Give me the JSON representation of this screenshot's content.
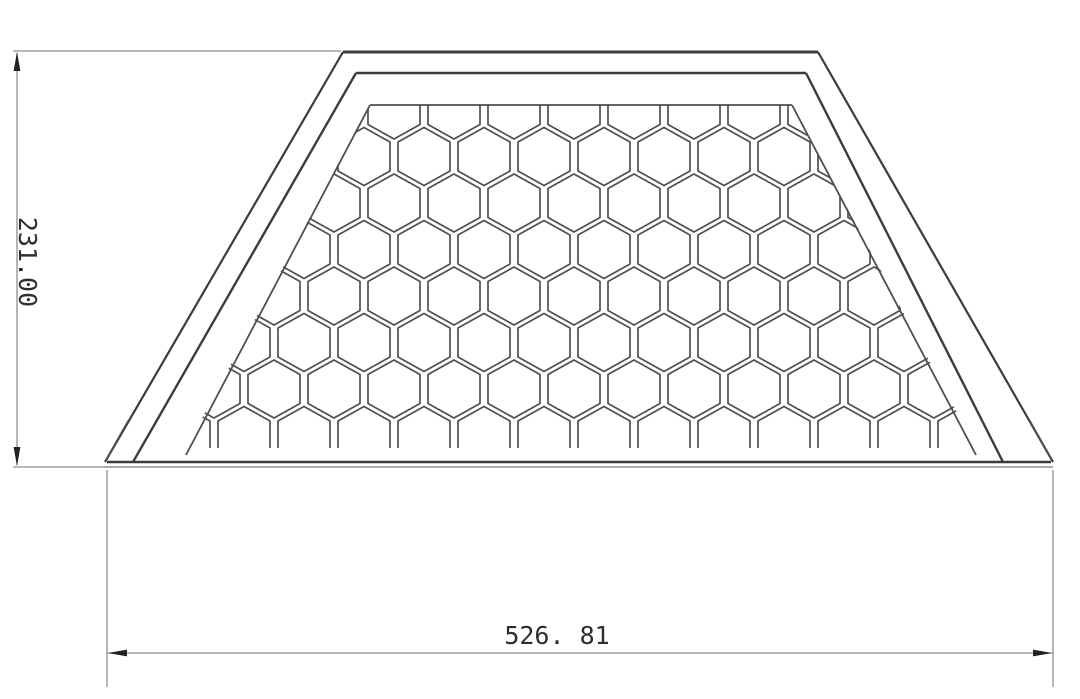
{
  "drawing": {
    "type": "technical-drawing",
    "view": "front-view-trapezoidal-honeycomb-grille",
    "background_color": "#ffffff",
    "line_colors": {
      "dark": "#3c3c3c",
      "medium": "#4f4f4f",
      "light": "#8f8f8f",
      "arrow": "#222222",
      "text": "#2e2e2e"
    },
    "dimensions": {
      "height": {
        "value": "231.00",
        "orientation": "vertical",
        "units_shown": false
      },
      "width": {
        "value": "526. 81",
        "orientation": "horizontal",
        "units_shown": false
      }
    },
    "honeycomb": {
      "pattern": "hexagonal",
      "hex_width": 52,
      "hex_height": 58,
      "pitch_x": 60,
      "pitch_y": 46.5,
      "first_row_center_y": 110,
      "even_row_base_x": 334,
      "odd_row_base_x": 364,
      "col_start": -3,
      "col_end": 11,
      "rows": 8,
      "clip_polygon": [
        [
          370,
          105
        ],
        [
          792,
          105
        ],
        [
          976,
          448
        ],
        [
          186,
          448
        ]
      ]
    }
  }
}
